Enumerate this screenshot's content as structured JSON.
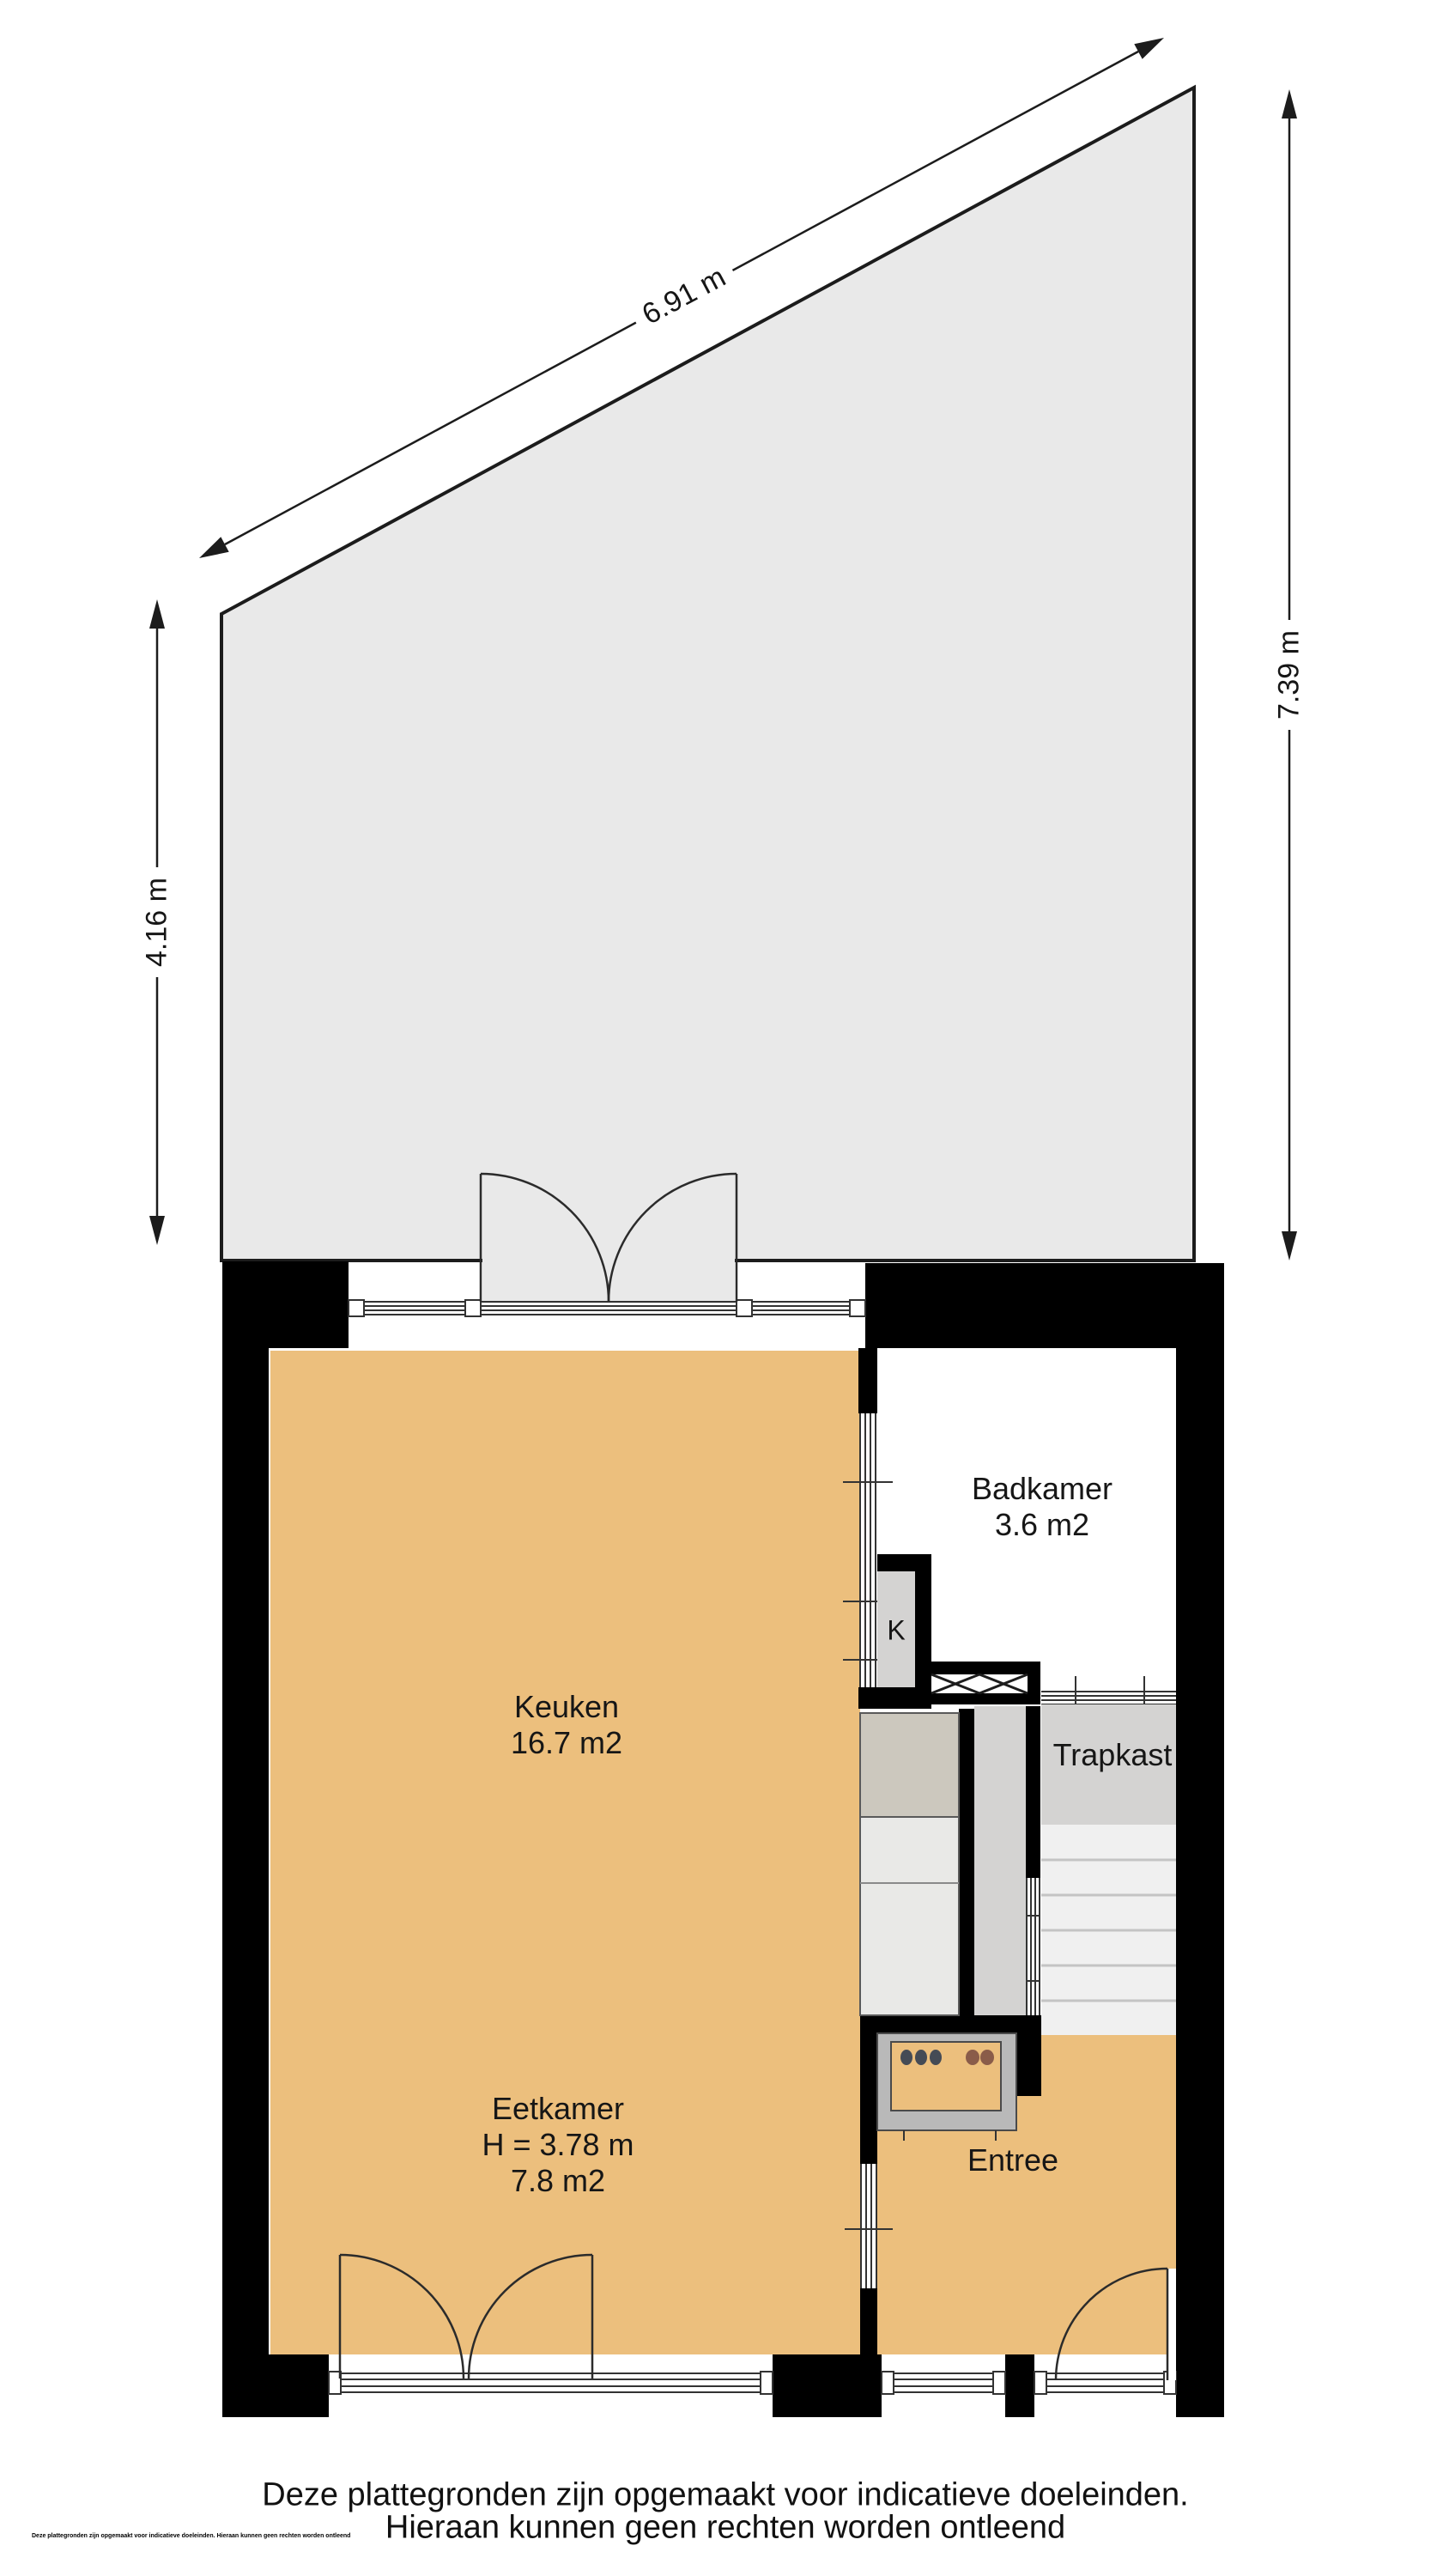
{
  "dimensions": {
    "top_diagonal": "6.91 m",
    "right": "7.39 m",
    "left": "4.16 m"
  },
  "rooms": {
    "keuken": {
      "name": "Keuken",
      "area": "16.7 m2"
    },
    "badkamer": {
      "name": "Badkamer",
      "area": "3.6 m2"
    },
    "trapkast": {
      "name": "Trapkast"
    },
    "eetkamer": {
      "name": "Eetkamer",
      "height": "H = 3.78 m",
      "area": "7.8 m2"
    },
    "entree": {
      "name": "Entree"
    },
    "kast": {
      "label": "K"
    }
  },
  "footer": {
    "line1": "Deze plattegronden zijn opgemaakt voor indicatieve doeleinden.",
    "line2": "Hieraan kunnen geen rechten worden ontleend",
    "fineprint": "Deze plattegronden zijn opgemaakt voor indicatieve doeleinden. Hieraan kunnen geen rechten worden ontleend"
  },
  "colors": {
    "floor": "#ecbf7d",
    "garden": "#e9e9e9",
    "wall": "#000000",
    "cabinet": "#d4d3d2",
    "counter": "#e9e9e7",
    "counter_dark": "#ccc8be",
    "stove_frame": "#b9b9b9",
    "burner_dark": "#454b55",
    "burner_brown": "#8a5c49",
    "stair": "#f0f0f0"
  }
}
